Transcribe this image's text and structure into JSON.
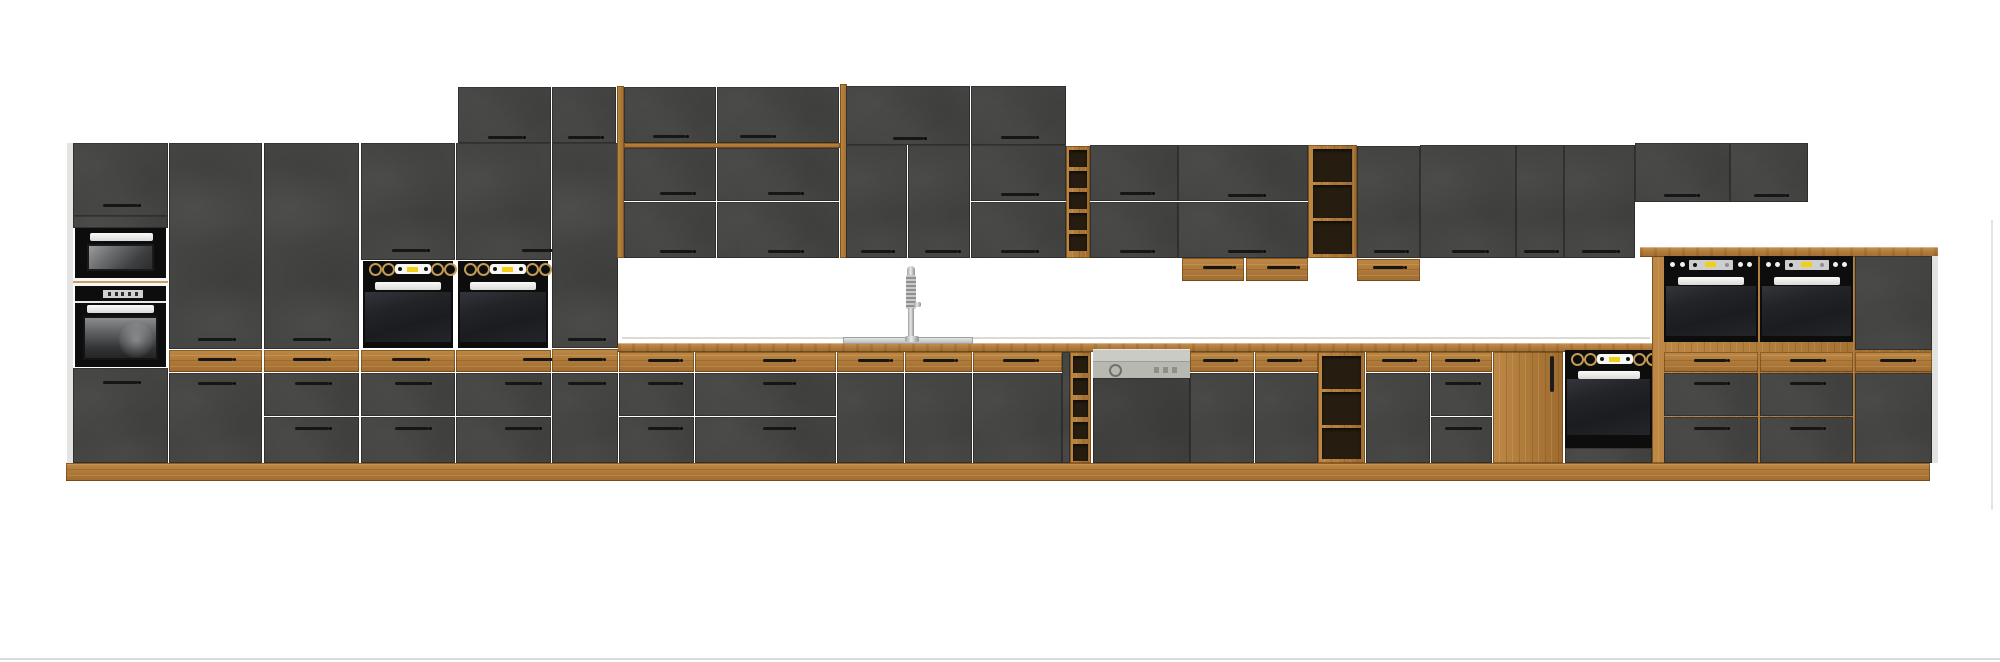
{
  "scene": {
    "kind": "kitchen-cabinet-set-product-image",
    "background": "#ffffff",
    "style": "dark matera grey fronts with oak accents, white backsplash gaps"
  },
  "colors": {
    "front_dark": "#454643",
    "oak": "#b17d3c",
    "oak_shadow": "#8a5f2a",
    "counter_oak": "#ad7839",
    "appliance_black": "#0d0d0e",
    "appliance_grey": "#c9c9c4",
    "steel": "#d7d8d6",
    "accent_yellow": "#f2ce17",
    "knob_gold": "#c29a52",
    "white_trim": "#f4f4f3",
    "background": "#ffffff"
  },
  "inventory": {
    "left_tall_bank": [
      "tall-housing-with-microwave-and-oven",
      "tall-larder",
      "tall-larder-with-drawers",
      "tall-oven-housing",
      "tall-oven-housing",
      "tall-cabinet"
    ],
    "top_box_row": 4,
    "over_sink_canopy": {
      "frame": "oak posts and rail",
      "flap_cabinets": 4
    },
    "wall_row": [
      "wall-top-boxes",
      "wall-doors",
      "flap-pair",
      "open-shelf-oak-unit",
      "flap-pair",
      "flap-pair-with-under-drawers",
      "open-shelf-oak-unit",
      "wall-door-with-under-drawer",
      "wall-doors",
      "short-wall-cabinets"
    ],
    "base_run": [
      "drawer-unit",
      "wide-drawer-unit",
      "sink-base",
      "sink-base",
      "base-door-unit",
      "open-shelf-base",
      "dishwasher-semi-integrated",
      "base-door-unit",
      "base-door-unit",
      "open-shelf-base",
      "base-door-unit",
      "drawer-unit",
      "oak-pantry-door",
      "built-in-oven-base"
    ],
    "right_highboard": [
      "compact-built-in-oven",
      "compact-built-in-oven",
      "cabinet-column-with-drawer"
    ]
  },
  "appliances": {
    "microwave": 1,
    "built_in_ovens": 6,
    "dishwasher": 1,
    "sink": 1,
    "faucet": 1
  }
}
